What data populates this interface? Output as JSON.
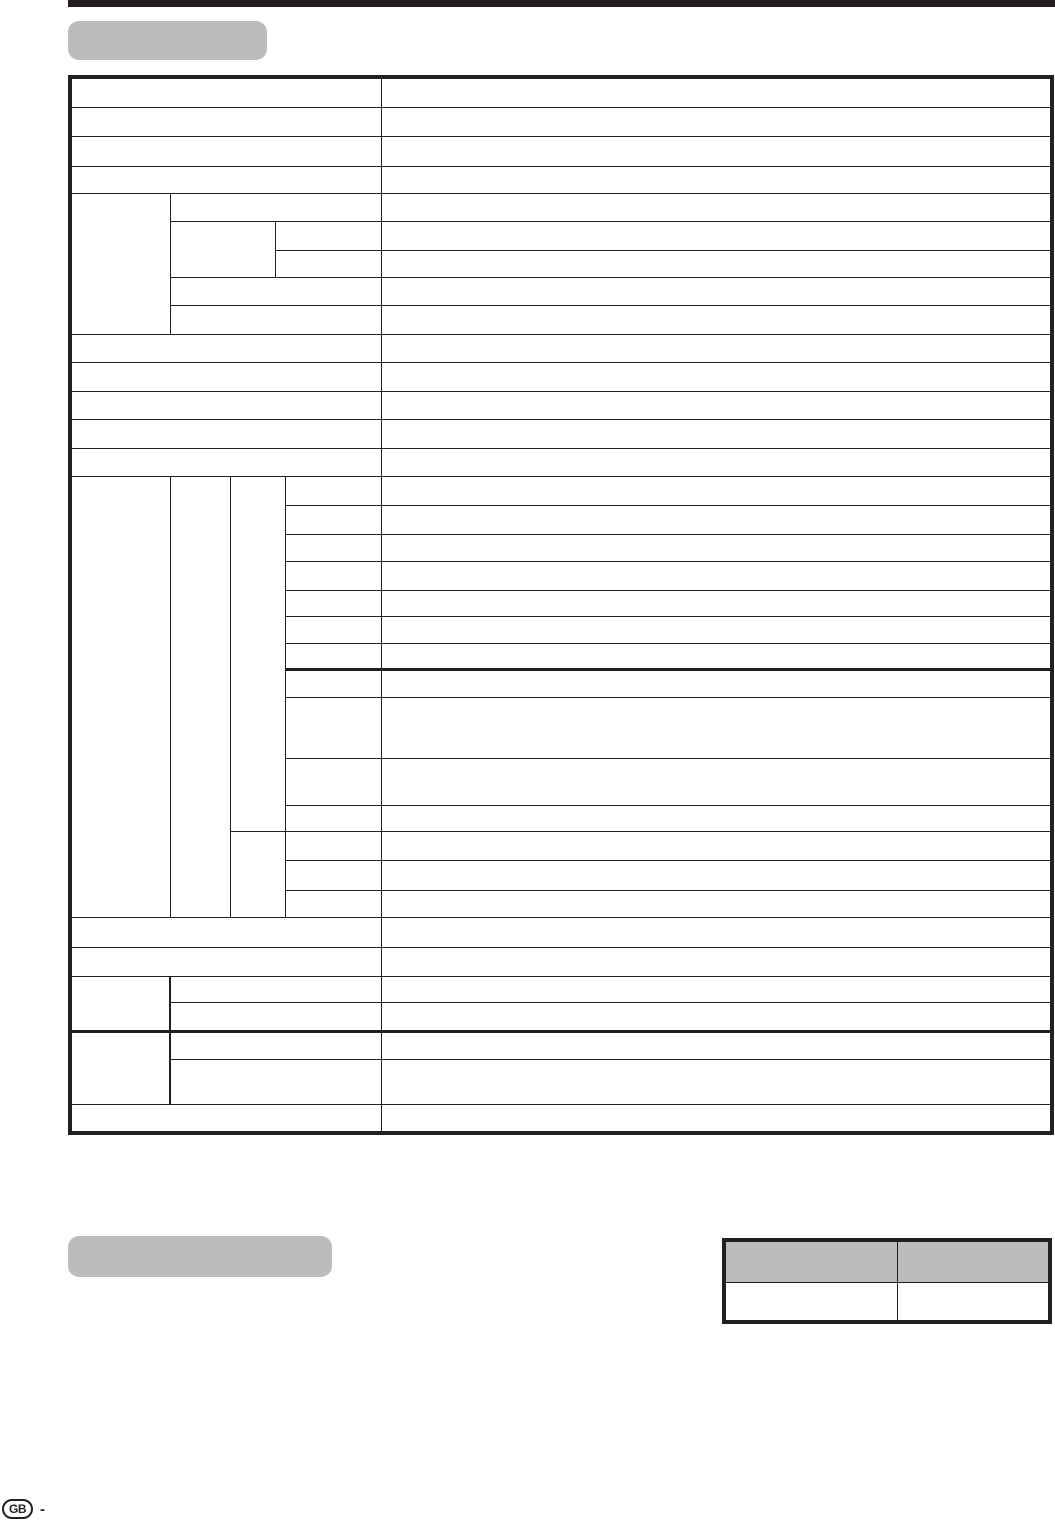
{
  "colors": {
    "ink": "#231f20",
    "panel_gray": "#bcbcbc",
    "page_background": "#ffffff"
  },
  "footer": {
    "country_code": "GB",
    "separator": "-"
  }
}
